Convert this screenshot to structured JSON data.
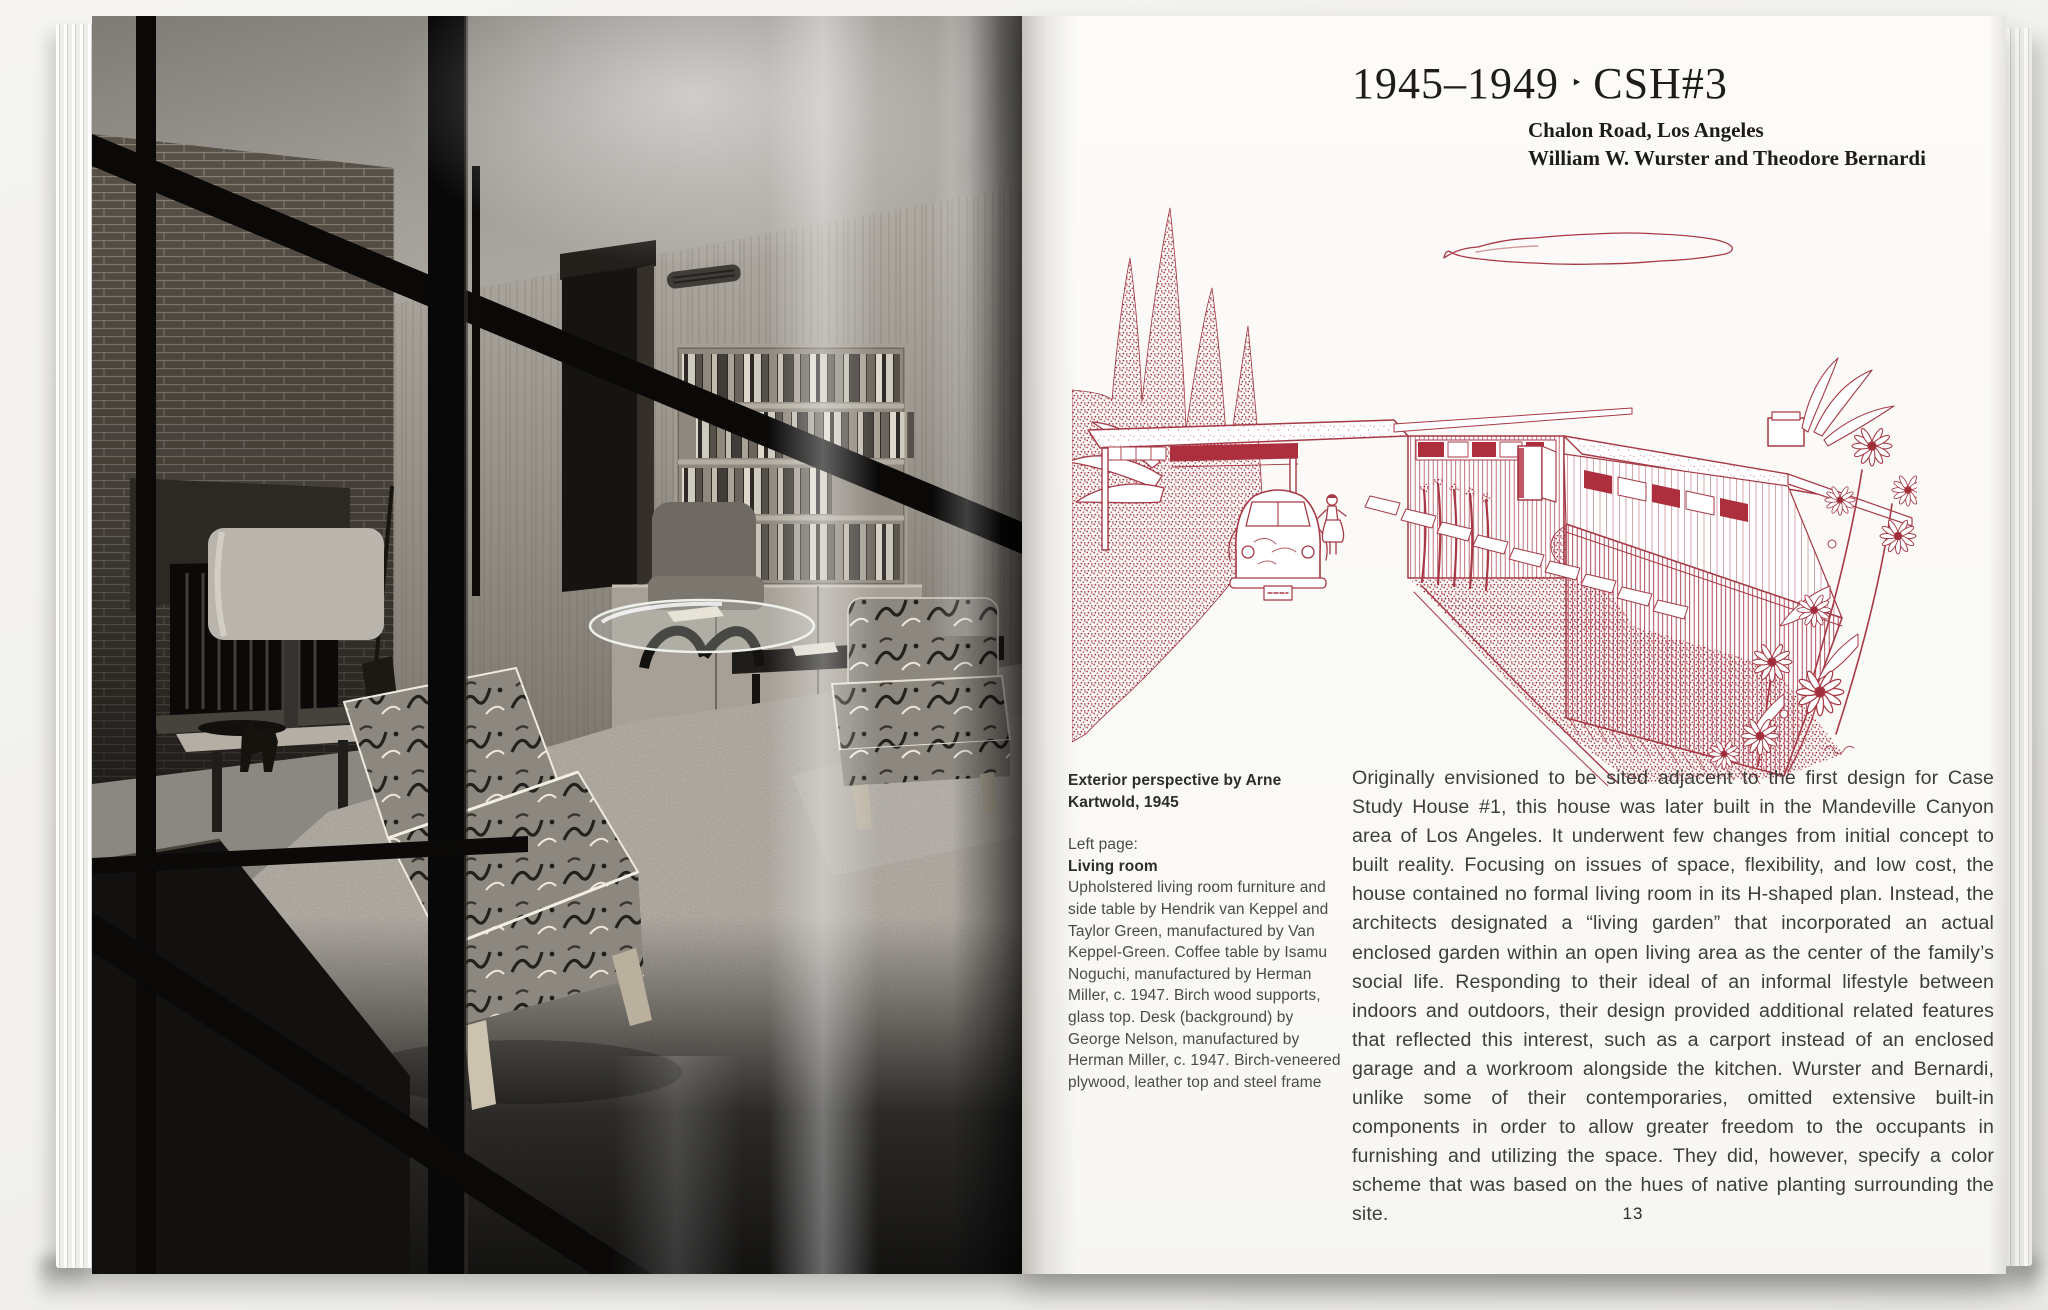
{
  "colors": {
    "accent_red": "#a63945",
    "solid_red": "#ad2e3d",
    "page_white": "#fbfaf7"
  },
  "left_page": {
    "photo_alt": "Black-and-white photograph of the living room seen through a glass wall"
  },
  "right_page": {
    "title": {
      "years": "1945–1949",
      "separator": "‣",
      "code": "CSH#3"
    },
    "subtitle_line1": "Chalon Road, Los Angeles",
    "subtitle_line2": "William W. Wurster and Theodore Bernardi",
    "illustration_alt": "Red ink perspective drawing of Case Study House #3 with carport, car, cypress trees, garden path and flowers",
    "caption": {
      "credit": "Exterior perspective by Arne Kartwold, 1945",
      "left_page_label": "Left page:",
      "photo_title": "Living room",
      "description": "Upholstered living room furniture and side table by Hendrik van Keppel and Taylor Green, manufactured by Van Keppel-Green. Coffee table by Isamu Noguchi, manufactured by Herman Miller, c. 1947. Birch wood supports, glass top. Desk (background) by George Nelson, manufactured by Herman Miller, c. 1947. Birch-veneered plywood, leather top and steel frame"
    },
    "body_text": "Originally envisioned to be sited adjacent to the first design for Case Study House #1, this house was later built in the Mandeville Canyon area of Los Angeles. It underwent few changes from initial concept to built reality. Focusing on issues of space, flexibility, and low cost, the house contained no formal living room in its H-shaped plan. Instead, the architects designated a “living garden” that incorporated an actual enclosed garden within an open living area as the center of the family’s social life. Responding to their ideal of an informal lifestyle between indoors and outdoors, their design provided additional related features that reflected this interest, such as a carport instead of an enclosed garage and a workroom alongside the kitchen. Wurster and Bernardi, unlike some of their contemporaries, omitted extensive built-in components in order to allow greater freedom to the occupants in furnishing and utilizing the space. They did, however, specify a color scheme that was based on the hues of native planting surrounding the site.",
    "page_number": "13"
  }
}
